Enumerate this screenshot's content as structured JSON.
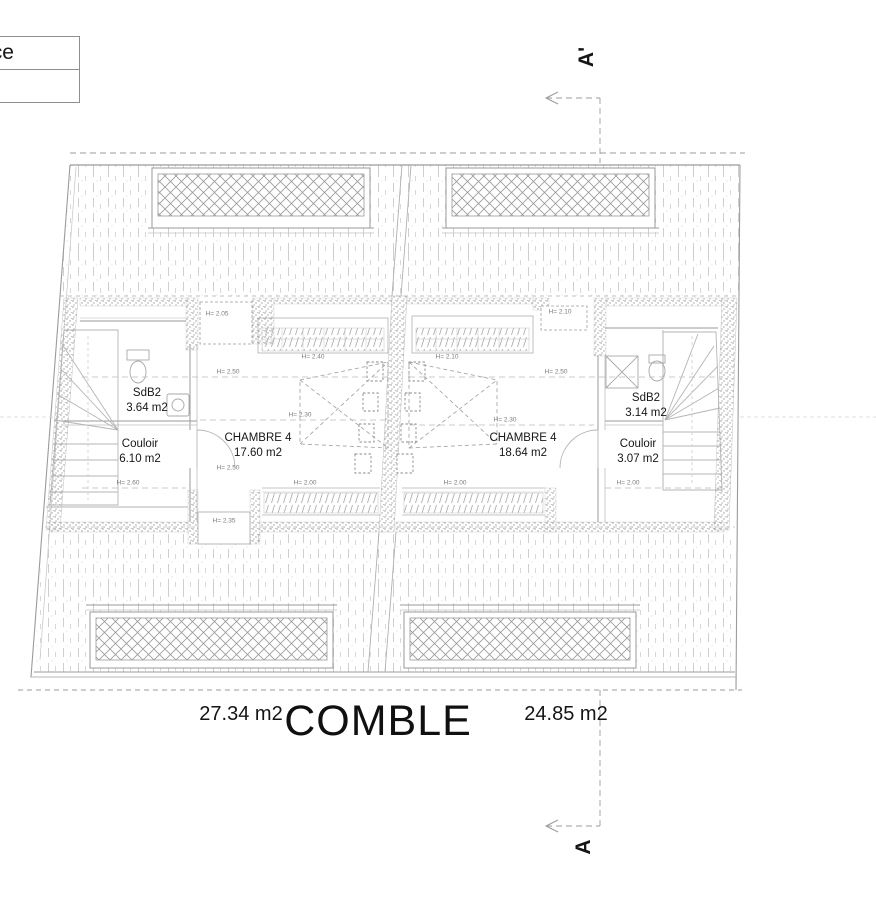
{
  "legend": {
    "row1": "enance",
    "row2": "0ca"
  },
  "section_markers": {
    "top": "A'",
    "bottom": "A"
  },
  "plan": {
    "title": "COMBLE",
    "unit_areas": {
      "left": "27.34 m2",
      "right": "24.85 m2"
    },
    "rooms": [
      {
        "name": "SdB2",
        "area": "3.64 m2"
      },
      {
        "name": "Couloir",
        "area": "6.10 m2"
      },
      {
        "name": "CHAMBRE 4",
        "area": "17.60 m2"
      },
      {
        "name": "CHAMBRE 4",
        "area": "18.64 m2"
      },
      {
        "name": "SdB2",
        "area": "3.14 m2"
      },
      {
        "name": "Couloir",
        "area": "3.07 m2"
      }
    ],
    "height_labels": [
      {
        "text": "H= 2.05",
        "x": 217,
        "y": 314
      },
      {
        "text": "H= 2.10",
        "x": 560,
        "y": 312
      },
      {
        "text": "H= 2.40",
        "x": 313,
        "y": 357
      },
      {
        "text": "H= 2.10",
        "x": 447,
        "y": 357
      },
      {
        "text": "H= 2.50",
        "x": 228,
        "y": 372
      },
      {
        "text": "H= 2.50",
        "x": 556,
        "y": 372
      },
      {
        "text": "H= 2.30",
        "x": 300,
        "y": 415
      },
      {
        "text": "H= 2.30",
        "x": 505,
        "y": 420
      },
      {
        "text": "H= 2.60",
        "x": 128,
        "y": 483
      },
      {
        "text": "H= 2.00",
        "x": 305,
        "y": 483
      },
      {
        "text": "H= 2.00",
        "x": 455,
        "y": 483
      },
      {
        "text": "H= 2.00",
        "x": 628,
        "y": 483
      },
      {
        "text": "H= 2.50",
        "x": 228,
        "y": 468
      },
      {
        "text": "H= 2.35",
        "x": 224,
        "y": 521
      }
    ]
  },
  "colors": {
    "line": "#9b9b9b",
    "hatch": "#c0c0c0",
    "text": "#111111"
  }
}
